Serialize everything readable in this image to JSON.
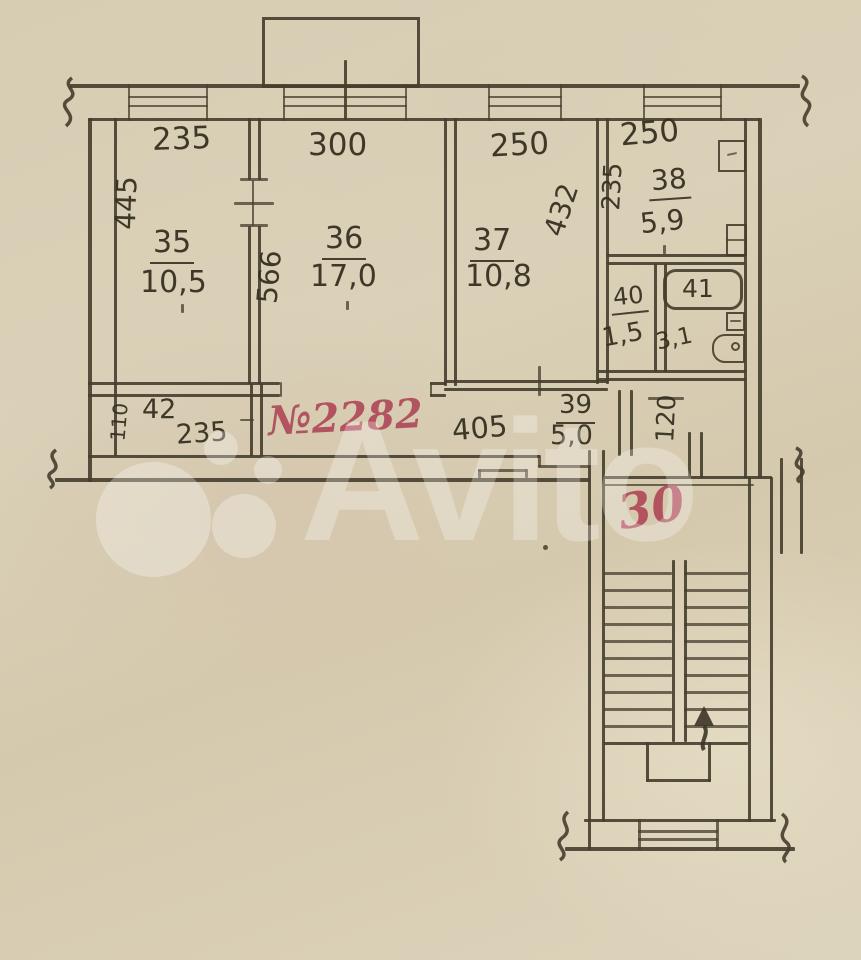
{
  "brand_watermark": "Avito",
  "colors": {
    "paper": "#d8ceb4",
    "ink": "#463e2d",
    "red_ink": "#ad4254"
  },
  "dims": {
    "top_235": "235",
    "top_300": "300",
    "top_250_a": "250",
    "top_250_b": "250",
    "left_445": "445",
    "v_566": "566",
    "v_432": "432",
    "v_235_kitchen": "235",
    "v_110": "110",
    "v_120": "120",
    "closet_235": "235",
    "hall_405": "405"
  },
  "rooms": {
    "r35_num": "35",
    "r35_area": "10,5",
    "r36_num": "36",
    "r36_area": "17,0",
    "r37_num": "37",
    "r37_area": "10,8",
    "r38_num": "38",
    "r38_area": "5,9",
    "r39_num": "39",
    "r39_area": "5,0",
    "r40_num": "40",
    "r40_area": "1,5",
    "r41_num": "41",
    "r41_area": "3,1",
    "r42_num": "42"
  },
  "red_marks": {
    "apartment_no": "№2282",
    "stair_landing": "30"
  }
}
